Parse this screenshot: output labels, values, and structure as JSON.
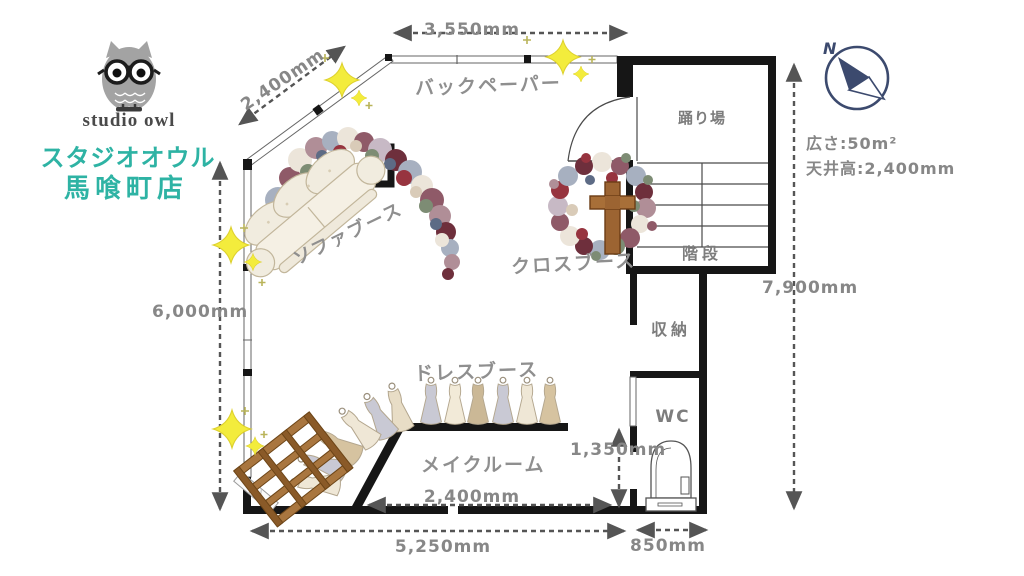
{
  "brand": {
    "logo_text": "studio owl",
    "store_line1": "スタジオオウル",
    "store_line2": "馬喰町店"
  },
  "info": {
    "north": "N",
    "area": "広さ:50m²",
    "ceiling_height": "天井高:2,400mm"
  },
  "rooms": {
    "landing": "踊り場",
    "stairs": "階段",
    "storage": "収納",
    "wc": "WC"
  },
  "booths": {
    "backpaper": "バックペーパー",
    "sofa": "ソファブース",
    "cross": "クロスブース",
    "dress": "ドレスブース",
    "makeup": "メイクルーム"
  },
  "dimensions": {
    "top_width": "3,550mm",
    "diagonal_wall": "2,400mm",
    "left_height": "6,000mm",
    "right_height": "7,900mm",
    "wc_inner_height": "1,350mm",
    "makeup_width": "2,400mm",
    "bottom_width": "5,250mm",
    "wc_width": "850mm"
  },
  "colors": {
    "brand_teal": "#2eb3a4",
    "wall_black": "#161616",
    "label_gray": "#8b8b8b",
    "sparkle_yellow": "#f3ec3c",
    "compass_navy": "#3c4a6e",
    "wood_brown": "#9c6432"
  }
}
